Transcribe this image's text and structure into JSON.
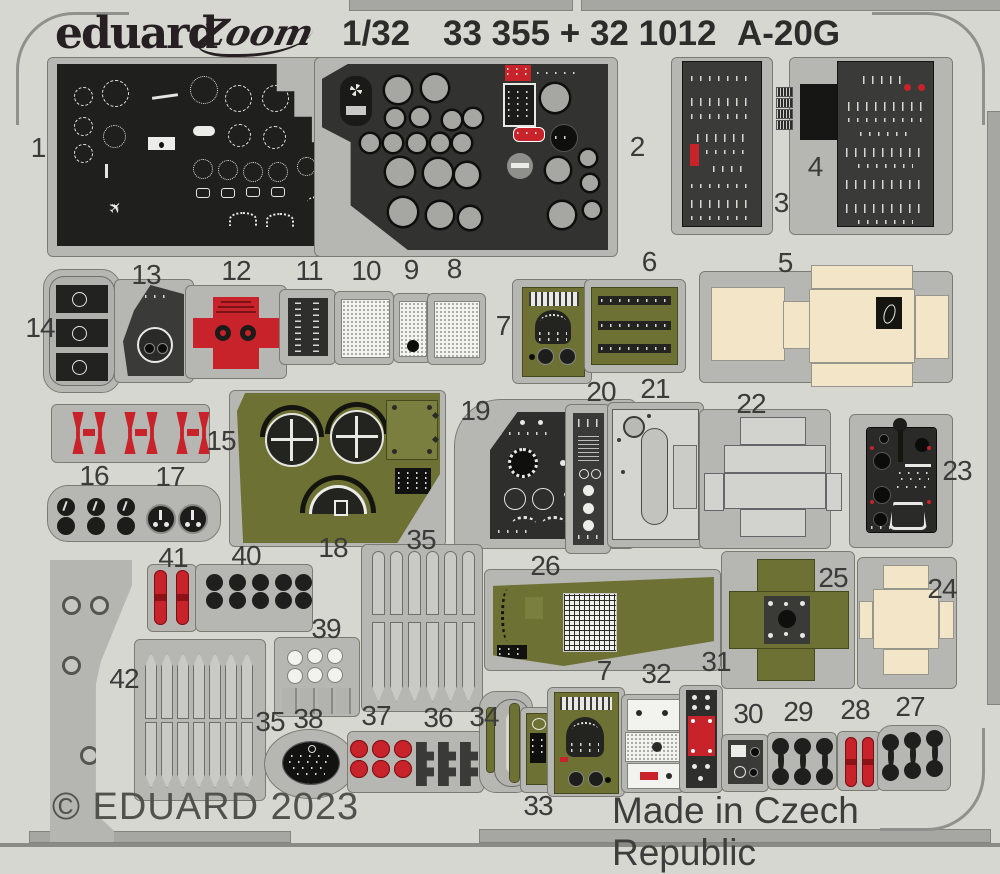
{
  "header": {
    "brand": "eduard",
    "series_logo": "Zoom",
    "scale": "1/32",
    "catalog": "33 355 + 32 1012",
    "subject": "A-20G"
  },
  "footer": {
    "copyright": "© EDUARD 2023",
    "origin": "Made in Czech Republic"
  },
  "icons": {
    "plane": "✈"
  },
  "colors": {
    "sheet": "#d7d7d2",
    "carrier_frame": "#b6b6b2",
    "black_panel": "#222220",
    "dark_panel": "#3a3a38",
    "olive": "#6d7134",
    "red": "#c8232a",
    "cream": "#f2e5c8"
  },
  "parts": [
    {
      "num": "1",
      "x": 38,
      "y": 148
    },
    {
      "num": "2",
      "x": 637,
      "y": 147
    },
    {
      "num": "3",
      "x": 781,
      "y": 203
    },
    {
      "num": "4",
      "x": 815,
      "y": 167
    },
    {
      "num": "13",
      "x": 146,
      "y": 275
    },
    {
      "num": "12",
      "x": 236,
      "y": 271
    },
    {
      "num": "11",
      "x": 309,
      "y": 271
    },
    {
      "num": "10",
      "x": 366,
      "y": 271
    },
    {
      "num": "9",
      "x": 411,
      "y": 270
    },
    {
      "num": "8",
      "x": 454,
      "y": 269
    },
    {
      "num": "14",
      "x": 40,
      "y": 328
    },
    {
      "num": "7",
      "x": 503,
      "y": 326
    },
    {
      "num": "6",
      "x": 649,
      "y": 262
    },
    {
      "num": "5",
      "x": 785,
      "y": 263
    },
    {
      "num": "20",
      "x": 601,
      "y": 392
    },
    {
      "num": "21",
      "x": 655,
      "y": 389
    },
    {
      "num": "22",
      "x": 751,
      "y": 404
    },
    {
      "num": "19",
      "x": 475,
      "y": 411
    },
    {
      "num": "15",
      "x": 221,
      "y": 441
    },
    {
      "num": "23",
      "x": 957,
      "y": 471
    },
    {
      "num": "16",
      "x": 94,
      "y": 476
    },
    {
      "num": "17",
      "x": 170,
      "y": 477
    },
    {
      "num": "18",
      "x": 333,
      "y": 548
    },
    {
      "num": "35",
      "x": 421,
      "y": 540
    },
    {
      "num": "26",
      "x": 545,
      "y": 566
    },
    {
      "num": "25",
      "x": 833,
      "y": 578
    },
    {
      "num": "24",
      "x": 942,
      "y": 589
    },
    {
      "num": "41",
      "x": 173,
      "y": 558
    },
    {
      "num": "40",
      "x": 246,
      "y": 556
    },
    {
      "num": "39",
      "x": 326,
      "y": 629
    },
    {
      "num": "42",
      "x": 124,
      "y": 679
    },
    {
      "num": "35",
      "x": 270,
      "y": 722
    },
    {
      "num": "38",
      "x": 308,
      "y": 719
    },
    {
      "num": "37",
      "x": 376,
      "y": 716
    },
    {
      "num": "36",
      "x": 438,
      "y": 718
    },
    {
      "num": "34",
      "x": 484,
      "y": 717
    },
    {
      "num": "7",
      "x": 604,
      "y": 671
    },
    {
      "num": "32",
      "x": 656,
      "y": 674
    },
    {
      "num": "31",
      "x": 716,
      "y": 662
    },
    {
      "num": "30",
      "x": 748,
      "y": 714
    },
    {
      "num": "29",
      "x": 798,
      "y": 712
    },
    {
      "num": "28",
      "x": 855,
      "y": 710
    },
    {
      "num": "27",
      "x": 910,
      "y": 707
    },
    {
      "num": "33",
      "x": 538,
      "y": 806
    }
  ]
}
